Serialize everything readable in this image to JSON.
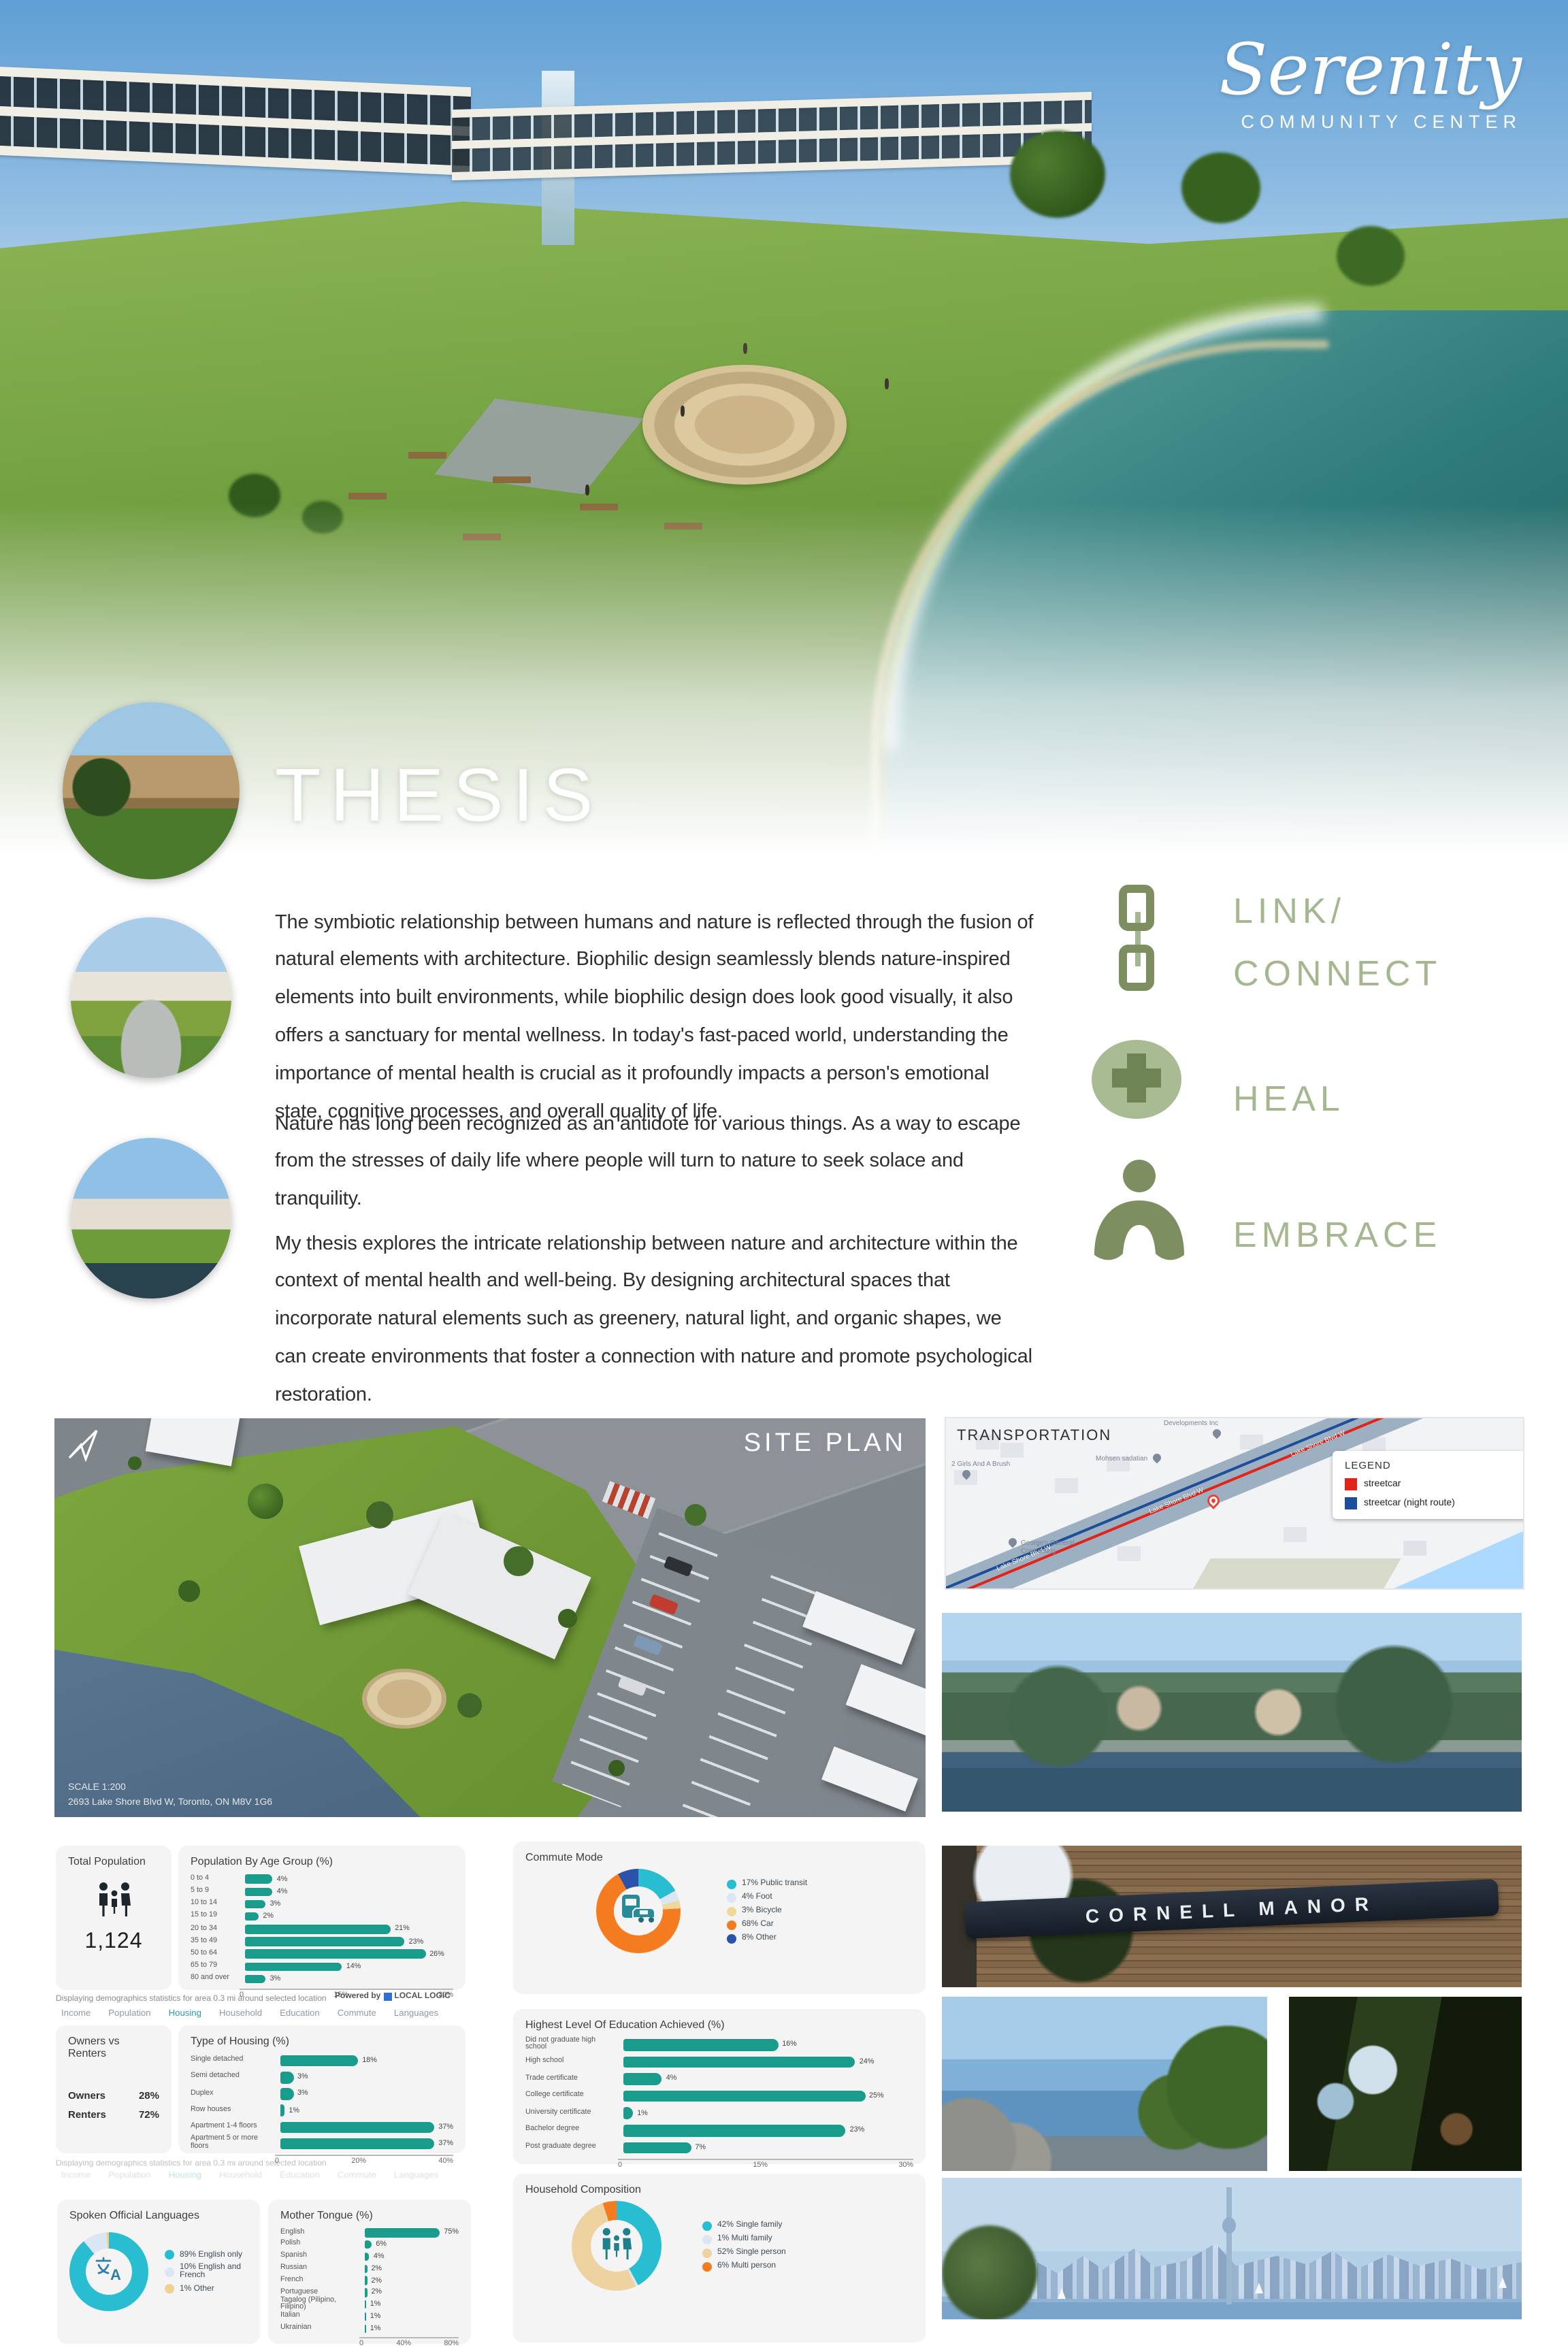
{
  "brand": {
    "title": "Serenity",
    "subtitle": "COMMUNITY CENTER"
  },
  "thesis": {
    "heading": "THESIS",
    "p1": "The symbiotic relationship between humans and nature is reflected through the fusion of natural elements with architecture. Biophilic design seamlessly blends nature-inspired elements into built environments, while biophilic design does look good visually, it also offers a sanctuary for mental wellness. In today's fast-paced world, understanding the importance of mental health is crucial as it profoundly impacts a person's emotional state, cognitive processes, and overall quality of life.",
    "p2": "Nature has long been recognized as an antidote for various things. As a way to escape from the stresses of daily life where people will turn to nature to seek solace and tranquility.",
    "p3": "My thesis explores the intricate relationship between nature and architecture within the context of mental health and well-being. By designing architectural spaces that incorporate natural elements such as greenery, natural light, and organic shapes, we can create environments that foster a connection with nature and promote psychological restoration."
  },
  "values": {
    "link": {
      "line1": "LINK/",
      "line2": "CONNECT"
    },
    "heal": {
      "label": "HEAL"
    },
    "embrace": {
      "label": "EMBRACE"
    }
  },
  "site_plan": {
    "title": "SITE PLAN",
    "scale": "SCALE 1:200",
    "address": "2693 Lake Shore Blvd W, Toronto, ON M8V 1G6"
  },
  "transportation": {
    "title": "TRANSPORTATION",
    "legend_title": "LEGEND",
    "legend": [
      {
        "label": "streetcar",
        "color": "#e2231a"
      },
      {
        "label": "streetcar (night route)",
        "color": "#1b4e9b"
      }
    ],
    "road_label": "Lake Shore Blvd W",
    "pins": {
      "p1": "Developments Inc",
      "p2": "Mohsen sadatian",
      "p3": "2 Girls And A Brush",
      "p4": "George's General Contracting"
    }
  },
  "photos": {
    "cornell_sign": "CORNELL MANOR"
  },
  "demographics": {
    "caption": "Displaying demographics statistics for area 0.3 mi around selected location",
    "powered_by": "Powered by",
    "powered_brand": "LOCAL LOGIC",
    "tabs": [
      "Income",
      "Population",
      "Housing",
      "Household",
      "Education",
      "Commute",
      "Languages"
    ],
    "active_tab": "Housing",
    "total_population": {
      "title": "Total Population",
      "value": "1,124"
    },
    "owners_vs_renters": {
      "title": "Owners vs Renters",
      "rows": [
        {
          "label": "Owners",
          "value": "28%"
        },
        {
          "label": "Renters",
          "value": "72%"
        }
      ]
    }
  },
  "chart_data": [
    {
      "id": "age",
      "type": "bar",
      "title": "Population By Age Group (%)",
      "categories": [
        "0 to 4",
        "5 to 9",
        "10 to 14",
        "15 to 19",
        "20 to 34",
        "35 to 49",
        "50 to 64",
        "65 to 79",
        "80 and over"
      ],
      "values": [
        4,
        4,
        3,
        2,
        21,
        23,
        26,
        14,
        3
      ],
      "xlim": [
        0,
        30
      ],
      "ticks": [
        "0",
        "15%",
        "30%"
      ],
      "bar_color": "#1a9c8d"
    },
    {
      "id": "housing",
      "type": "bar",
      "title": "Type of Housing (%)",
      "categories": [
        "Single detached",
        "Semi detached",
        "Duplex",
        "Row houses",
        "Apartment 1-4 floors",
        "Apartment 5 or more floors"
      ],
      "values": [
        18,
        3,
        3,
        1,
        37,
        37
      ],
      "xlim": [
        0,
        40
      ],
      "ticks": [
        "0",
        "20%",
        "40%"
      ],
      "bar_color": "#1a9c8d"
    },
    {
      "id": "tongue",
      "type": "bar",
      "title": "Mother Tongue (%)",
      "categories": [
        "English",
        "Polish",
        "Spanish",
        "Russian",
        "French",
        "Portuguese",
        "Tagalog (Pilipino, Filipino)",
        "Italian",
        "Ukrainian"
      ],
      "values": [
        75,
        6,
        4,
        2,
        2,
        2,
        1,
        1,
        1
      ],
      "xlim": [
        0,
        80
      ],
      "ticks": [
        "0",
        "40%",
        "80%"
      ],
      "bar_color": "#1a9c8d"
    },
    {
      "id": "education",
      "type": "bar",
      "title": "Highest Level Of Education Achieved (%)",
      "categories": [
        "Did not graduate high school",
        "High school",
        "Trade certificate",
        "College certificate",
        "University certificate",
        "Bachelor degree",
        "Post graduate degree"
      ],
      "values": [
        16,
        24,
        4,
        25,
        1,
        23,
        7
      ],
      "xlim": [
        0,
        30
      ],
      "ticks": [
        "0",
        "15%",
        "30%"
      ],
      "bar_color": "#1a9c8d"
    },
    {
      "id": "languages",
      "type": "donut",
      "title": "Spoken Official Languages",
      "segments": [
        {
          "label": "English only",
          "pct": 89,
          "color": "#29bdd1"
        },
        {
          "label": "English and French",
          "pct": 10,
          "color": "#dce6f2"
        },
        {
          "label": "Other",
          "pct": 1,
          "color": "#eed28e"
        }
      ]
    },
    {
      "id": "commute",
      "type": "donut",
      "title": "Commute Mode",
      "segments": [
        {
          "label": "Public transit",
          "pct": 17,
          "color": "#29bdd1"
        },
        {
          "label": "Foot",
          "pct": 4,
          "color": "#dce6f2"
        },
        {
          "label": "Bicycle",
          "pct": 3,
          "color": "#f0d79b"
        },
        {
          "label": "Car",
          "pct": 68,
          "color": "#f47b20"
        },
        {
          "label": "Other",
          "pct": 8,
          "color": "#2a52a8"
        }
      ]
    },
    {
      "id": "household",
      "type": "donut",
      "title": "Household Composition",
      "segments": [
        {
          "label": "Single family",
          "pct": 42,
          "color": "#29bdd1"
        },
        {
          "label": "Multi family",
          "pct": 1,
          "color": "#dce6f2"
        },
        {
          "label": "Single person",
          "pct": 52,
          "color": "#eed2a0"
        },
        {
          "label": "Multi person",
          "pct": 6,
          "color": "#f47b20"
        }
      ]
    },
    {
      "id": "total_population",
      "type": "stat",
      "title": "Total Population",
      "value": "1,124"
    },
    {
      "id": "owners_renters",
      "type": "table",
      "title": "Owners vs Renters",
      "rows": [
        [
          "Owners",
          "28%"
        ],
        [
          "Renters",
          "72%"
        ]
      ]
    }
  ]
}
